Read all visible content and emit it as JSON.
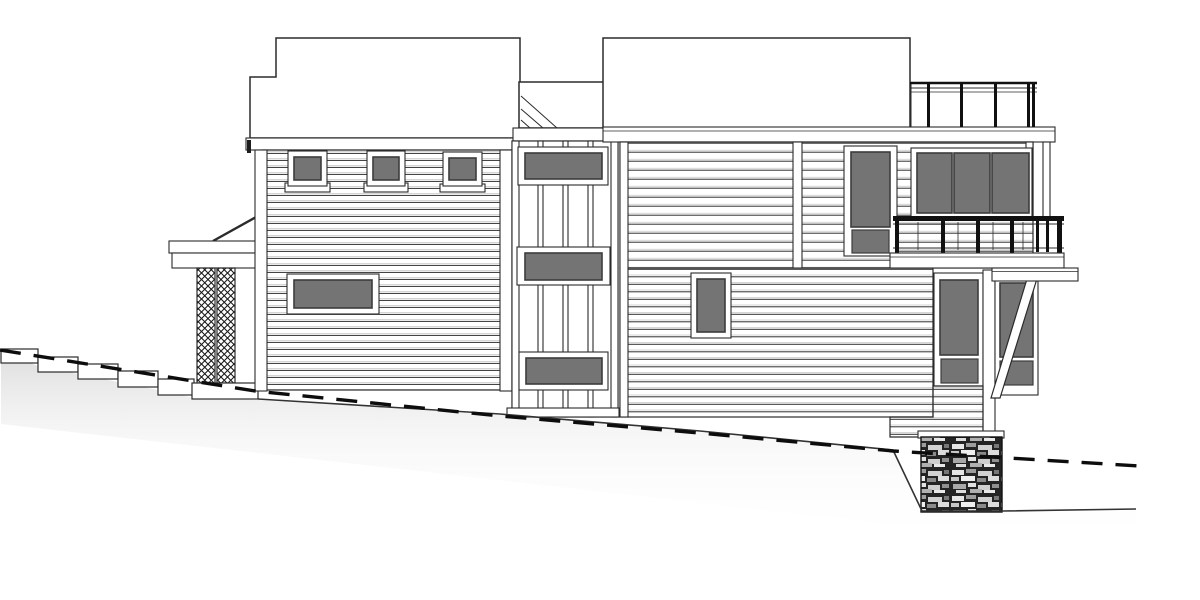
{
  "colors": {
    "background": "#ffffff",
    "ink": "#2b2b2b",
    "line_light": "#b9b9b9",
    "window_pane": "#747474",
    "pane_border": "#3c3c3c",
    "railing_black": "#111111",
    "stone_base": "#242424",
    "grade_line": "#0d0d0d"
  },
  "scene": {
    "type": "architectural-side-elevation-line-drawing",
    "buildings": [
      "left-wing",
      "center-tower",
      "right-wing"
    ],
    "left_wing_parts": [
      "stepped-flat-roof",
      "clapboard-siding-wall",
      "three-square-clerestory-windows",
      "horizontal-picture-window",
      "entry-porch-roof",
      "lattice-column"
    ],
    "center_tower_parts": [
      "flat-roof-with-slope-hatch",
      "vertical-batten-siding",
      "three-stacked-horizontal-windows",
      "base-band"
    ],
    "right_wing_parts": [
      "flat-roof",
      "rooftop-deck-glass-railing",
      "three-pane-corner-window",
      "tall-window-with-transom",
      "balcony-metal-railing",
      "small-vertical-window",
      "lower-bay-two-tall-windows",
      "diagonal-knee-brace",
      "support-post",
      "stone-foundation-pier"
    ],
    "site_parts": [
      "concrete-entry-steps",
      "existing-grade-dashed-line",
      "finished-ground-line",
      "hillside-shading"
    ]
  }
}
